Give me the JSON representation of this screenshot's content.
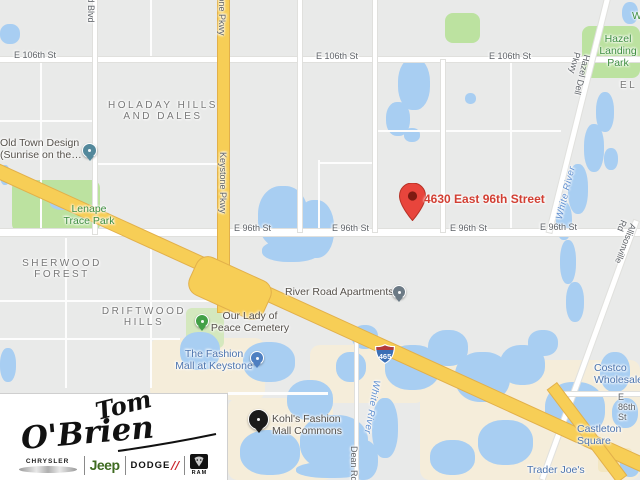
{
  "map": {
    "marker": {
      "label": "4630 East 96th Street"
    },
    "shield": {
      "route": "465"
    },
    "colors": {
      "marker_red": "#E8453C",
      "marker_label_red": "#D23F33",
      "highway_yellow": "#F7CE56",
      "water_blue": "#A8CEF2",
      "park_green": "#BCE2A0",
      "land_gray": "#E9EAE9",
      "commercial_beige": "#F5EDDA",
      "shield_blue": "#3B6FB5",
      "shield_red": "#B33A3A"
    },
    "labels": [
      {
        "name": "street-e-106th-st-1",
        "text": "E 106th St",
        "x": 14,
        "y": 50,
        "type": "street",
        "i": false
      },
      {
        "name": "street-e-106th-st-2",
        "text": "E 106th St",
        "x": 316,
        "y": 51,
        "type": "street",
        "i": false
      },
      {
        "name": "street-e-106th-st-3",
        "text": "E 106th St",
        "x": 489,
        "y": 51,
        "type": "street",
        "i": false
      },
      {
        "name": "street-e-96th-st-1",
        "text": "E 96th St",
        "x": 234,
        "y": 223,
        "type": "street",
        "i": false
      },
      {
        "name": "street-e-96th-st-2",
        "text": "E 96th St",
        "x": 332,
        "y": 223,
        "type": "street",
        "i": false
      },
      {
        "name": "street-e-96th-st-3",
        "text": "E 96th St",
        "x": 450,
        "y": 223,
        "type": "street",
        "i": false
      },
      {
        "name": "street-e-96th-st-4",
        "text": "E 96th St",
        "x": 540,
        "y": 222,
        "type": "street",
        "i": false
      },
      {
        "name": "street-e-86th-st",
        "text": "E 86th St",
        "x": 618,
        "y": 392,
        "type": "street",
        "i": false
      },
      {
        "name": "street-field-blvd",
        "text": "field Blvd",
        "x": 96,
        "y": -14,
        "type": "street",
        "rot": 90,
        "i": false
      },
      {
        "name": "street-keystone-pkwy-top",
        "text": "Keystone Pkwy",
        "x": 227,
        "y": -26,
        "type": "street",
        "rot": 90,
        "i": false
      },
      {
        "name": "street-keystone-pkwy",
        "text": "Keystone Pkwy",
        "x": 228,
        "y": 152,
        "type": "street",
        "rot": 90,
        "i": false
      },
      {
        "name": "street-hazel-dell-pkwy",
        "text": "Hazel Dell Pkwy",
        "x": 592,
        "y": 56,
        "type": "street",
        "rot": 104,
        "i": false
      },
      {
        "name": "street-allisonville-rd",
        "text": "Allisonville Rd",
        "x": 638,
        "y": 226,
        "type": "street",
        "rot": 112,
        "i": false
      },
      {
        "name": "street-dean-rd",
        "text": "Dean Rd",
        "x": 359,
        "y": 446,
        "type": "street",
        "rot": 90,
        "i": false
      },
      {
        "name": "water-white-river-north",
        "text": "White River",
        "x": 554,
        "y": 218,
        "type": "water",
        "rot": -76,
        "i": false
      },
      {
        "name": "water-white-river-south",
        "text": "White River",
        "x": 382,
        "y": 381,
        "type": "water",
        "rot": 100,
        "i": false
      },
      {
        "name": "hood-holaday-hills",
        "text": "HOLADAY HILLS\nAND DALES",
        "x": 163,
        "y": 100,
        "type": "hood",
        "c": true,
        "i": false
      },
      {
        "name": "hood-sherwood-forest",
        "text": "SHERWOOD\nFOREST",
        "x": 62,
        "y": 258,
        "type": "hood",
        "c": true,
        "i": false
      },
      {
        "name": "hood-driftwood-hills",
        "text": "DRIFTWOOD\nHILLS",
        "x": 144,
        "y": 306,
        "type": "hood",
        "c": true,
        "i": false
      },
      {
        "name": "hood-partial-el",
        "text": "EL",
        "x": 620,
        "y": 80,
        "type": "hood",
        "i": false
      },
      {
        "name": "park-lenape-trace",
        "text": "Lenape\nTrace Park",
        "x": 89,
        "y": 203,
        "type": "parklbl",
        "c": true,
        "i": false
      },
      {
        "name": "park-hazel-landing",
        "text": "Hazel\nLanding Park",
        "x": 618,
        "y": 33,
        "type": "parklbl",
        "c": true,
        "i": false
      },
      {
        "name": "park-partial-w",
        "text": "W",
        "x": 632,
        "y": 10,
        "type": "parklbl",
        "i": false
      },
      {
        "name": "poi-old-town-design",
        "text": "Old Town Design\n(Sunrise on the…",
        "x": 0,
        "y": 137,
        "type": "poi",
        "i": true,
        "pin": {
          "x": 82,
          "y": 143,
          "color": "#53889B",
          "size": 13
        }
      },
      {
        "name": "poi-our-lady-of-peace-cemetery",
        "text": "Our Lady of\nPeace Cemetery",
        "x": 250,
        "y": 310,
        "type": "poi",
        "c": true,
        "i": true,
        "pin": {
          "x": 195,
          "y": 314,
          "color": "#43A047",
          "size": 12
        }
      },
      {
        "name": "poi-fashion-mall-keystone",
        "text": "The Fashion\nMall at Keystone",
        "x": 214,
        "y": 348,
        "type": "poib",
        "c": true,
        "i": true,
        "pin": {
          "x": 250,
          "y": 351,
          "color": "#4E7FC1",
          "size": 12
        }
      },
      {
        "name": "poi-river-road-apartments",
        "text": "River Road Apartments",
        "x": 285,
        "y": 286,
        "type": "poi",
        "i": true,
        "pin": {
          "x": 392,
          "y": 285,
          "color": "#6C7A85",
          "size": 12
        }
      },
      {
        "name": "poi-kohls-fashion-mall-commons",
        "text": "Kohl's Fashion\nMall Commons",
        "x": 272,
        "y": 413,
        "type": "poi",
        "i": true,
        "pin": {
          "x": 248,
          "y": 409,
          "color": "#1A1A1A",
          "size": 19
        }
      },
      {
        "name": "poi-castleton-square",
        "text": "Castleton Square",
        "x": 577,
        "y": 423,
        "type": "poib",
        "i": true
      },
      {
        "name": "poi-costco-wholesale",
        "text": "Costco Wholesale",
        "x": 594,
        "y": 362,
        "type": "poib",
        "i": true
      },
      {
        "name": "poi-trader-joes",
        "text": "Trader Joe's",
        "x": 527,
        "y": 464,
        "type": "poib",
        "i": true
      }
    ]
  },
  "logo_box": {
    "script_top": "Tom",
    "script_bottom": "O'Brien",
    "brand_chrysler": "CHRYSLER",
    "brand_jeep": "Jeep",
    "brand_dodge": "DODGE",
    "dodge_slashes": "∕∕",
    "brand_ram": "RAM"
  }
}
